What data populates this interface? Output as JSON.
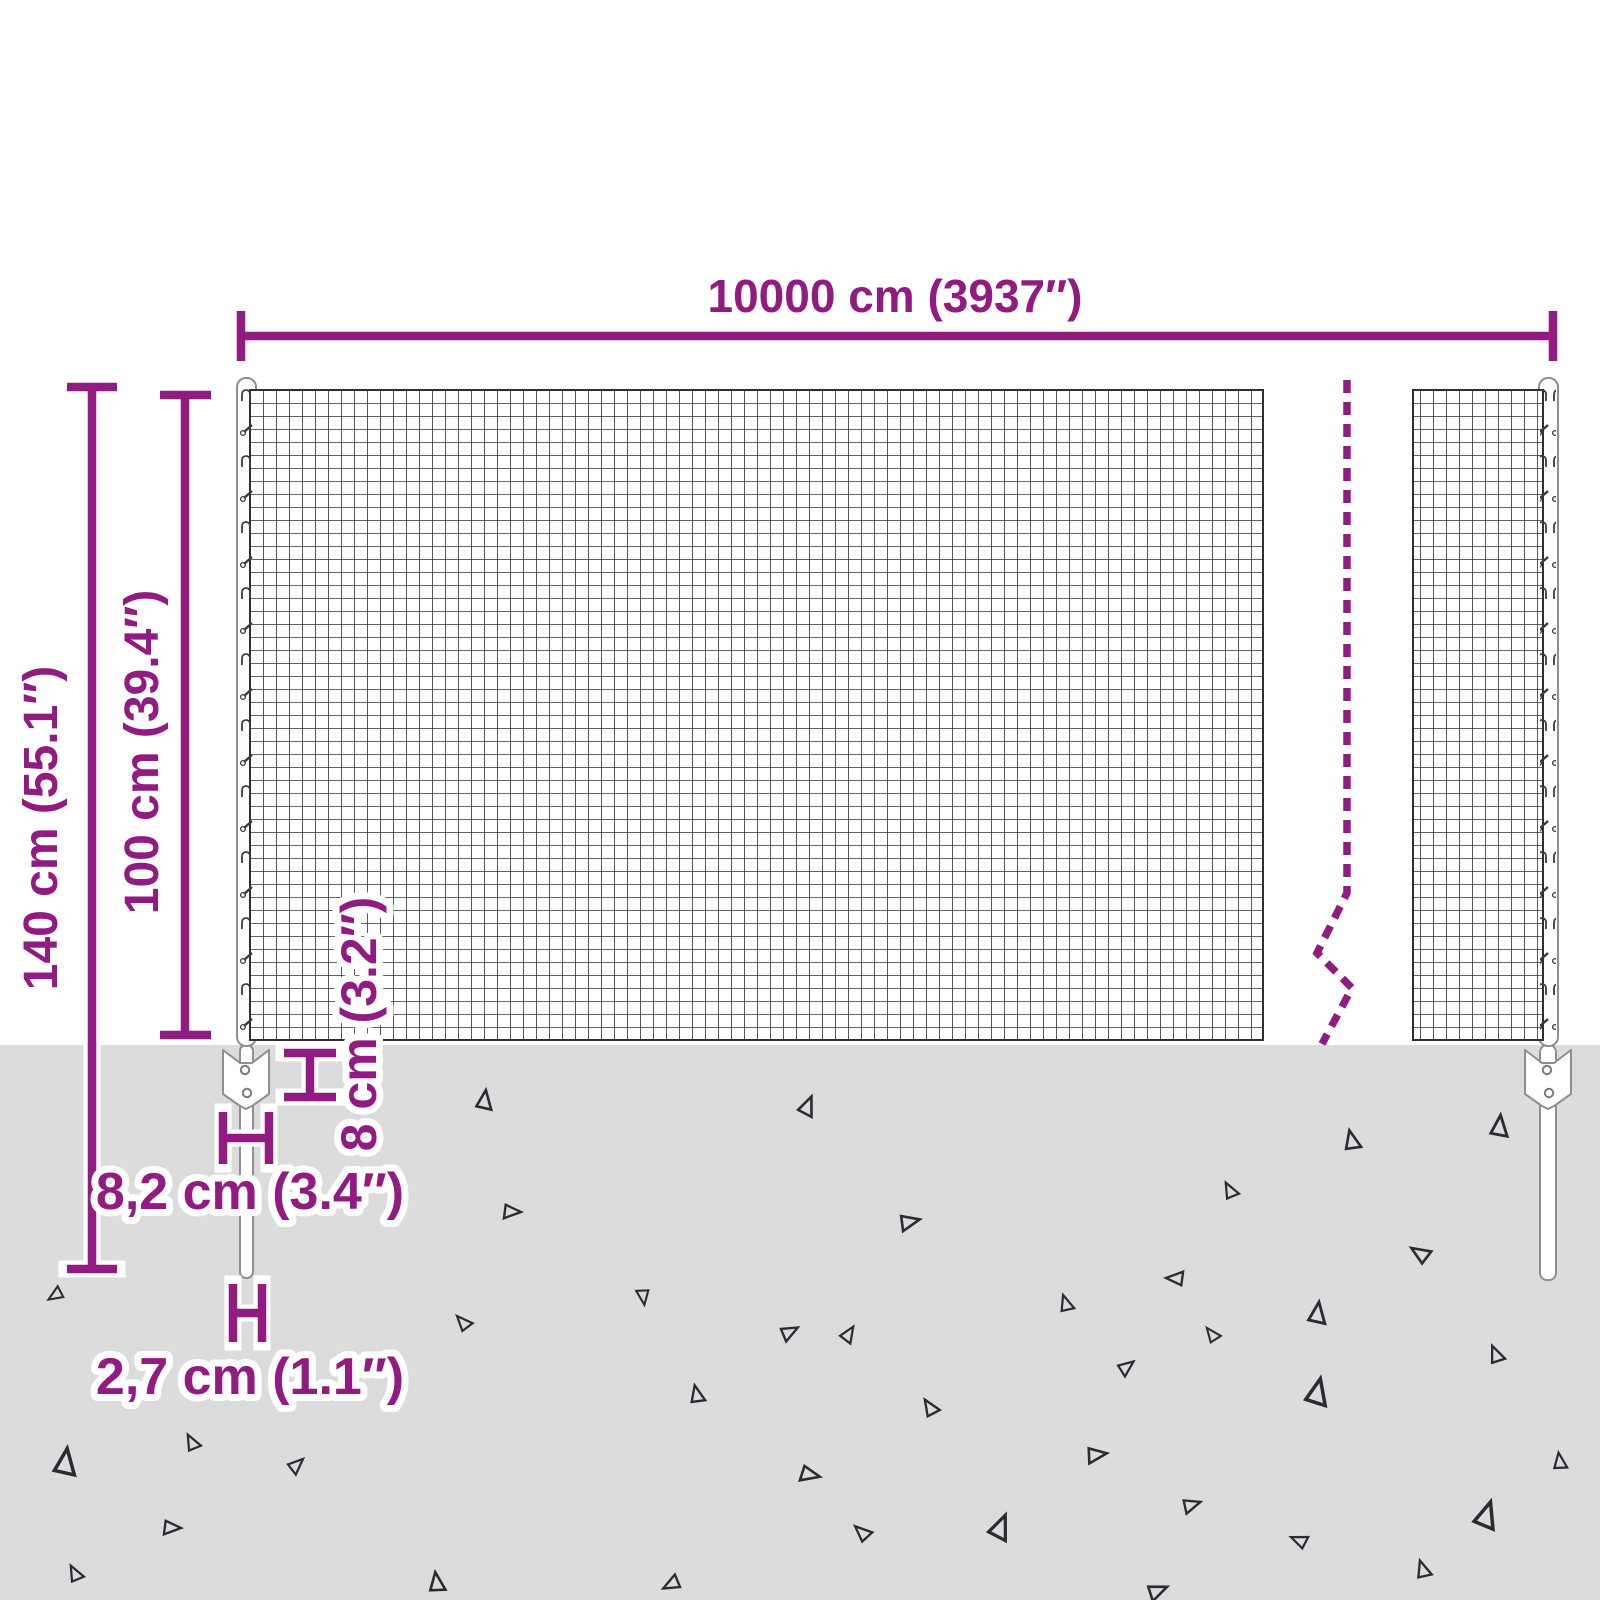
{
  "title": "Wire mesh fence dimension diagram",
  "colors": {
    "accent": "#911b80",
    "ground": "#dcdcdc",
    "mesh_line": "#2e2e36",
    "post_outline": "#8f8f8f",
    "triangle_outline": "#2b2b33"
  },
  "dimensions": {
    "total_width": {
      "label": "10000 cm (3937″)"
    },
    "total_height": {
      "label": "140 cm (55.1″)"
    },
    "mesh_height": {
      "label": "100 cm (39.4″)"
    },
    "bracket_height": {
      "label": "8 cm (3.2″)"
    },
    "bracket_width": {
      "label": "8,2 cm (3.4″)"
    },
    "post_width": {
      "label": "2,7 cm (1.1″)"
    }
  },
  "ground_texture": "scattered-triangles",
  "break_symbol": "dashed-zigzag-line"
}
